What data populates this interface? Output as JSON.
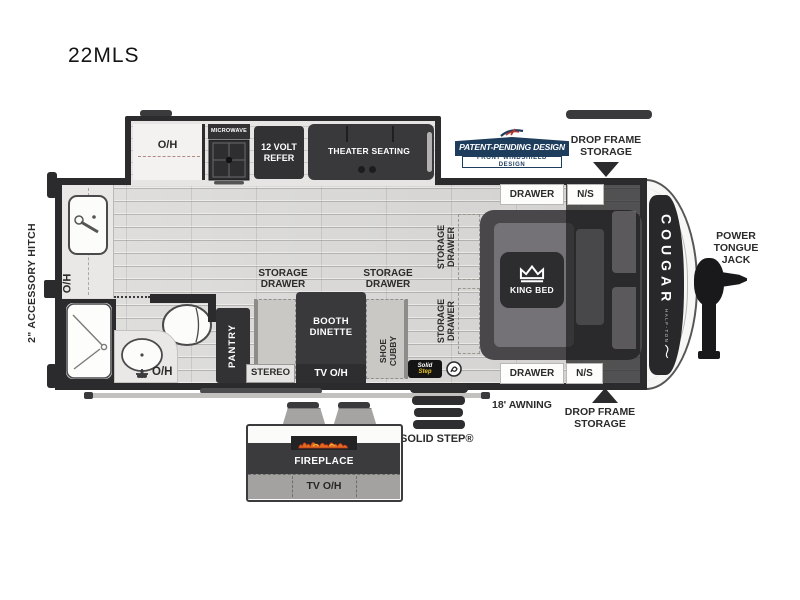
{
  "title": "22MLS",
  "labels": {
    "oh": "O/H",
    "storage_drawer": "STORAGE\nDRAWER",
    "drawer": "DRAWER",
    "ns": "N/S",
    "tv_oh": "TV O/H"
  },
  "exterior": {
    "accessory_hitch": "2\" ACCESSORY HITCH",
    "power_tongue_jack": "POWER\nTONGUE\nJACK",
    "awning": "18' AWNING",
    "drop_frame_storage": "DROP FRAME\nSTORAGE",
    "solid_step": "SOLID STEP®",
    "brand": "COUGAR",
    "brand_sub": "HALF-TON"
  },
  "badge": {
    "line1": "PATENT-PENDING DESIGN",
    "line2": "FRONT WINDSHIELD DESIGN"
  },
  "kitchen_slide": {
    "microwave": "MICROWAVE",
    "refer": "12 VOLT\nREFER",
    "theater": "THEATER SEATING"
  },
  "interior": {
    "pantry": "PANTRY",
    "booth": "BOOTH\nDINETTE",
    "stereo": "STEREO",
    "shoe_cubby": "SHOE\nCUBBY",
    "king_bed": "KING BED"
  },
  "fireplace_slide": {
    "fireplace": "FIREPLACE"
  },
  "solidstep_logo": {
    "line1": "Solid",
    "line2": "Step"
  },
  "colors": {
    "dark": "#2e2e30",
    "navy": "#1e3c5c",
    "red": "#b03a33",
    "flame": "#e06a1e",
    "floor": "#dbdad8"
  }
}
